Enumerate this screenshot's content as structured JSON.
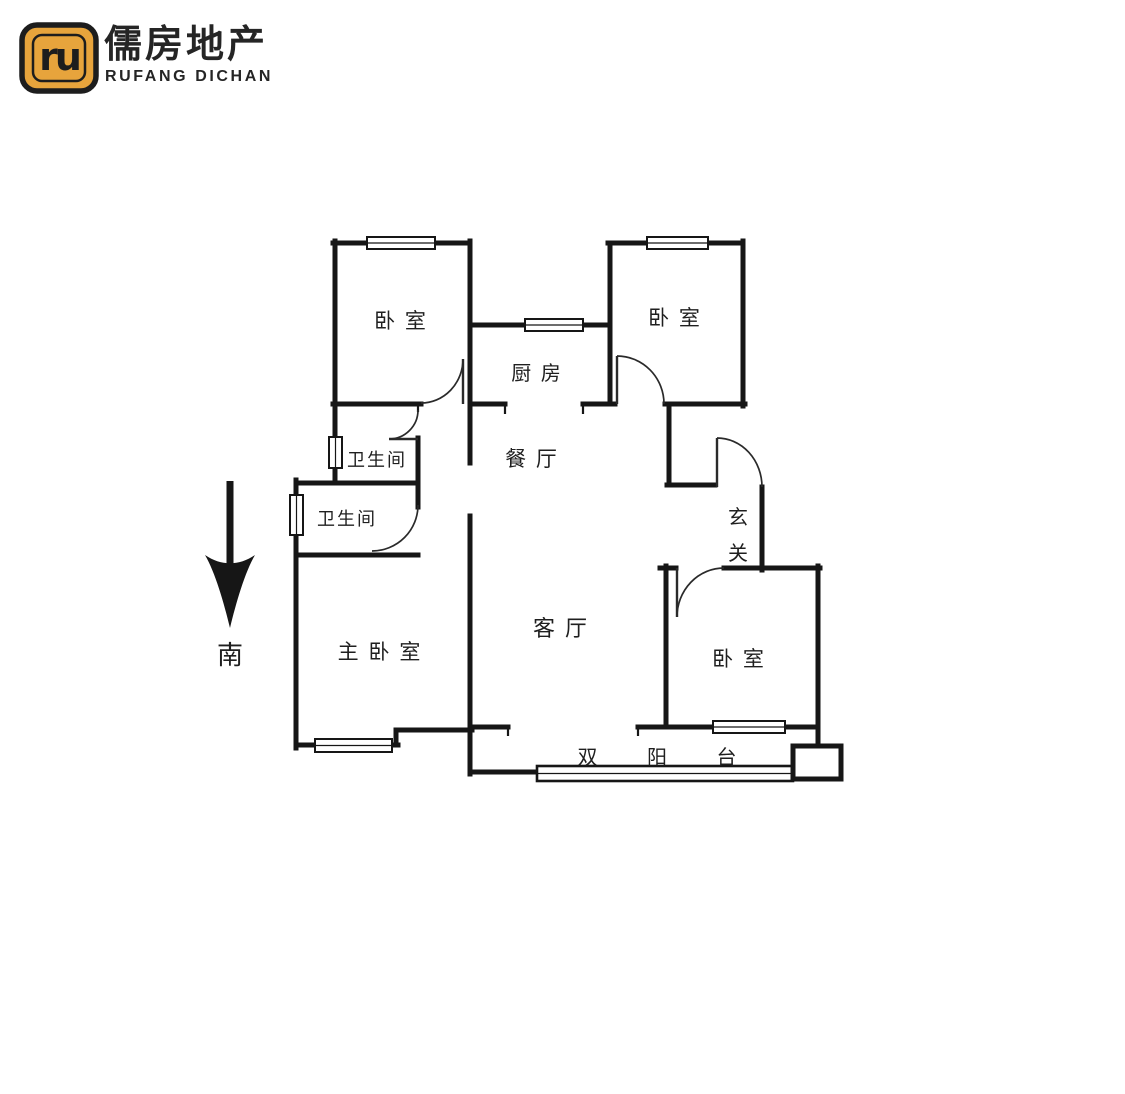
{
  "brand": {
    "monogram": "ru",
    "name_cn": "儒房地产",
    "name_en": "RUFANG DICHAN",
    "colors": {
      "gold": "#E7A43C",
      "ink": "#1D1D1D",
      "wall": "#161616"
    }
  },
  "floorplan": {
    "labels": {
      "bedroom_top_left": "卧 室",
      "bedroom_top_right": "卧 室",
      "kitchen": "厨 房",
      "dining": "餐 厅",
      "bathroom_upper": "卫生间",
      "bathroom_lower": "卫生间",
      "master_bedroom": "主 卧 室",
      "living_room": "客 厅",
      "entry_char_1": "玄",
      "entry_char_2": "关",
      "bedroom_right": "卧 室",
      "balcony": "双 阳 台"
    },
    "compass": {
      "south": "南"
    }
  }
}
